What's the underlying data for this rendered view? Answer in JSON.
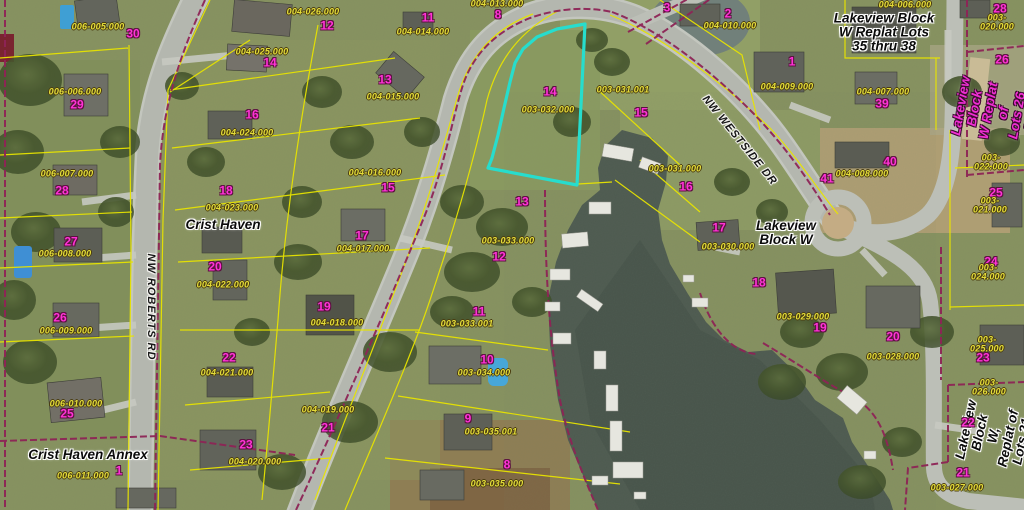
{
  "map": {
    "description": "County GIS parcel map over aerial imagery",
    "colors": {
      "highlight": "#27ddcd",
      "parcel_line": "#e8e400",
      "boundary_line": "#8e2456",
      "lot_number": "#ff32d6",
      "parcel_id": "#e4dd3a",
      "water": "#4d5a50",
      "road": "#b6b9b1"
    },
    "highlighted_parcel": {
      "lot": "14",
      "parcel_id": "003-032.000"
    },
    "labels": {
      "streets": [
        {
          "t": "NW ROBERTS RD",
          "x": 150,
          "y": 307,
          "rot": 90
        },
        {
          "t": "NW WESTSIDE DR",
          "x": 739,
          "y": 141,
          "rot": 51
        }
      ],
      "subdivisions": [
        {
          "t": "Crist Haven",
          "x": 223,
          "y": 225,
          "rot": 0
        },
        {
          "t": "Crist Haven Annex",
          "x": 88,
          "y": 455,
          "rot": 0
        },
        {
          "t": "Lakeview\nBlock W",
          "x": 786,
          "y": 233,
          "rot": 0
        },
        {
          "t": "Lakeview Block\nW Replat Lots\n35 thru 38",
          "x": 884,
          "y": 33,
          "rot": 0
        },
        {
          "t": "Lakeview Block\nW Replat of\nLots 26 & 27",
          "x": 996,
          "y": 112,
          "rot": -80,
          "magenta": true
        },
        {
          "t": "Lakeview Block\nW, Replat of\nLots 21 and 22",
          "x": 1001,
          "y": 437,
          "rot": -78
        }
      ],
      "lot_numbers": [
        {
          "t": "30",
          "x": 133,
          "y": 34
        },
        {
          "t": "12",
          "x": 327,
          "y": 26
        },
        {
          "t": "11",
          "x": 428,
          "y": 18
        },
        {
          "t": "8",
          "x": 498,
          "y": 15
        },
        {
          "t": "3",
          "x": 667,
          "y": 8
        },
        {
          "t": "2",
          "x": 728,
          "y": 14
        },
        {
          "t": "28",
          "x": 1000,
          "y": 9
        },
        {
          "t": "14",
          "x": 270,
          "y": 63
        },
        {
          "t": "29",
          "x": 77,
          "y": 105
        },
        {
          "t": "13",
          "x": 385,
          "y": 80
        },
        {
          "t": "1",
          "x": 792,
          "y": 62
        },
        {
          "t": "26",
          "x": 1002,
          "y": 60
        },
        {
          "t": "39",
          "x": 882,
          "y": 104
        },
        {
          "t": "16",
          "x": 252,
          "y": 115
        },
        {
          "t": "15",
          "x": 641,
          "y": 113
        },
        {
          "t": "14",
          "x": 550,
          "y": 92
        },
        {
          "t": "40",
          "x": 890,
          "y": 162
        },
        {
          "t": "41",
          "x": 827,
          "y": 179
        },
        {
          "t": "28",
          "x": 62,
          "y": 191
        },
        {
          "t": "18",
          "x": 226,
          "y": 191
        },
        {
          "t": "15",
          "x": 388,
          "y": 188
        },
        {
          "t": "16",
          "x": 686,
          "y": 187
        },
        {
          "t": "25",
          "x": 996,
          "y": 193
        },
        {
          "t": "13",
          "x": 522,
          "y": 202
        },
        {
          "t": "17",
          "x": 362,
          "y": 236
        },
        {
          "t": "17",
          "x": 719,
          "y": 228
        },
        {
          "t": "27",
          "x": 71,
          "y": 242
        },
        {
          "t": "12",
          "x": 499,
          "y": 257
        },
        {
          "t": "20",
          "x": 215,
          "y": 267
        },
        {
          "t": "24",
          "x": 991,
          "y": 262
        },
        {
          "t": "18",
          "x": 759,
          "y": 283
        },
        {
          "t": "19",
          "x": 324,
          "y": 307
        },
        {
          "t": "11",
          "x": 479,
          "y": 312
        },
        {
          "t": "26",
          "x": 60,
          "y": 318
        },
        {
          "t": "19",
          "x": 820,
          "y": 328
        },
        {
          "t": "20",
          "x": 893,
          "y": 337
        },
        {
          "t": "23",
          "x": 983,
          "y": 358
        },
        {
          "t": "22",
          "x": 229,
          "y": 358
        },
        {
          "t": "10",
          "x": 487,
          "y": 360
        },
        {
          "t": "25",
          "x": 67,
          "y": 414
        },
        {
          "t": "9",
          "x": 468,
          "y": 419
        },
        {
          "t": "22",
          "x": 968,
          "y": 423
        },
        {
          "t": "21",
          "x": 328,
          "y": 428
        },
        {
          "t": "23",
          "x": 246,
          "y": 445
        },
        {
          "t": "8",
          "x": 507,
          "y": 465
        },
        {
          "t": "1",
          "x": 119,
          "y": 471
        },
        {
          "t": "21",
          "x": 963,
          "y": 473
        }
      ],
      "parcel_ids": [
        {
          "t": "004-013.000",
          "x": 497,
          "y": 4
        },
        {
          "t": "004-006.000",
          "x": 905,
          "y": 5
        },
        {
          "t": "004-026.000",
          "x": 313,
          "y": 12
        },
        {
          "t": "003-020.000",
          "x": 997,
          "y": 23
        },
        {
          "t": "004-010.000",
          "x": 730,
          "y": 26
        },
        {
          "t": "006-005.000",
          "x": 98,
          "y": 27
        },
        {
          "t": "004-014.000",
          "x": 423,
          "y": 32
        },
        {
          "t": "004-025.000",
          "x": 262,
          "y": 52
        },
        {
          "t": "003-031.001",
          "x": 623,
          "y": 90
        },
        {
          "t": "004-009.000",
          "x": 787,
          "y": 87
        },
        {
          "t": "006-006.000",
          "x": 75,
          "y": 92
        },
        {
          "t": "004-007.000",
          "x": 883,
          "y": 92
        },
        {
          "t": "004-015.000",
          "x": 393,
          "y": 97
        },
        {
          "t": "003-032.000",
          "x": 548,
          "y": 110
        },
        {
          "t": "004-024.000",
          "x": 247,
          "y": 133
        },
        {
          "t": "003-022.000",
          "x": 991,
          "y": 163
        },
        {
          "t": "004-008.000",
          "x": 862,
          "y": 174
        },
        {
          "t": "003-031.000",
          "x": 675,
          "y": 169
        },
        {
          "t": "004-016.000",
          "x": 375,
          "y": 173
        },
        {
          "t": "006-007.000",
          "x": 67,
          "y": 174
        },
        {
          "t": "003-021.000",
          "x": 990,
          "y": 206
        },
        {
          "t": "004-023.000",
          "x": 232,
          "y": 208
        },
        {
          "t": "003-033.000",
          "x": 508,
          "y": 241
        },
        {
          "t": "003-030.000",
          "x": 728,
          "y": 247
        },
        {
          "t": "004-017.000",
          "x": 363,
          "y": 249
        },
        {
          "t": "006-008.000",
          "x": 65,
          "y": 254
        },
        {
          "t": "003-024.000",
          "x": 988,
          "y": 273
        },
        {
          "t": "004-022.000",
          "x": 223,
          "y": 285
        },
        {
          "t": "003-029.000",
          "x": 803,
          "y": 317
        },
        {
          "t": "004-018.000",
          "x": 337,
          "y": 323
        },
        {
          "t": "003-033.001",
          "x": 467,
          "y": 324
        },
        {
          "t": "006-009.000",
          "x": 66,
          "y": 331
        },
        {
          "t": "003-025.000",
          "x": 987,
          "y": 345
        },
        {
          "t": "003-028.000",
          "x": 893,
          "y": 357
        },
        {
          "t": "004-021.000",
          "x": 227,
          "y": 373
        },
        {
          "t": "003-034.000",
          "x": 484,
          "y": 373
        },
        {
          "t": "003-026.000",
          "x": 989,
          "y": 388
        },
        {
          "t": "006-010.000",
          "x": 76,
          "y": 404
        },
        {
          "t": "004-019.000",
          "x": 328,
          "y": 410
        },
        {
          "t": "003-035.001",
          "x": 491,
          "y": 432
        },
        {
          "t": "004-020.000",
          "x": 255,
          "y": 462
        },
        {
          "t": "006-011.000",
          "x": 83,
          "y": 476
        },
        {
          "t": "003-035.000",
          "x": 497,
          "y": 484
        },
        {
          "t": "003-027.000",
          "x": 957,
          "y": 488
        }
      ]
    }
  }
}
